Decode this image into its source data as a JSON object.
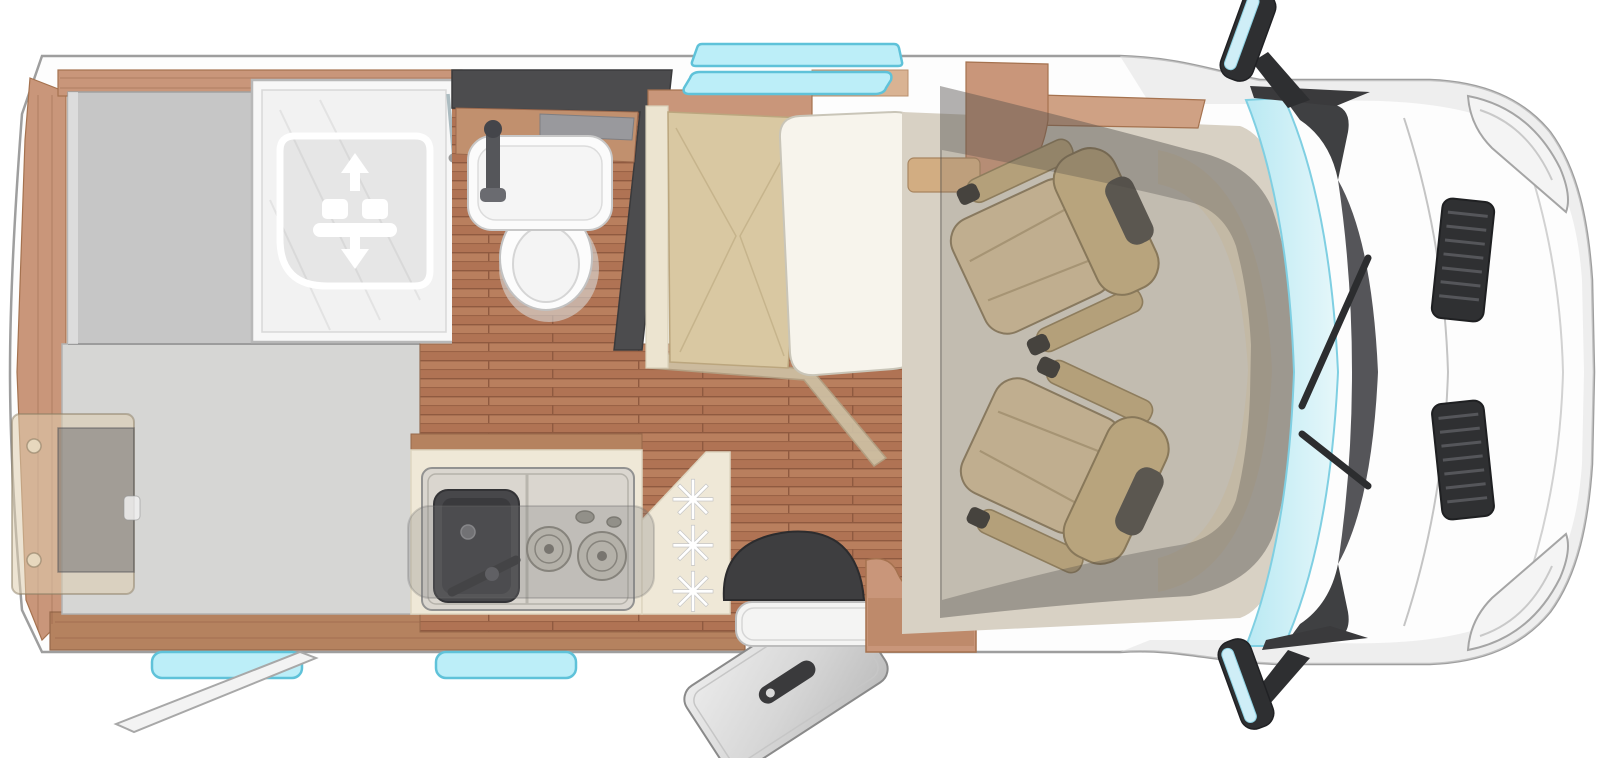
{
  "diagram": {
    "type": "motorhome-floorplan-top-view",
    "description": "Top-down 3D floor plan of a semi-integrated camper van: rear bed area with drop-down bed symbol, shower cabin, bathroom with washbasin and toilet, dark wardrobe wall, kitchen block with sink and two-burner hob, refrigerator position marked with snowflake symbols, half-dinette bench with table, two swivelled cab captain seats under translucent cab roof, open entry door with dark floor mat and wooden step, roof skylight and side windows, awning support arm, and the driving cab with windscreen, wipers, bonnet vents, headlights and two exterior mirrors.",
    "areas": [
      "rear-bed-platform-upper",
      "rear-bed-platform-lower",
      "shower-cabin",
      "drop-down-bed-lift-icon",
      "bathroom",
      "washbasin",
      "toilet",
      "wardrobe-dark-wall",
      "kitchen-counter",
      "kitchen-sink",
      "two-burner-hob",
      "fridge-panel-with-snowflakes",
      "dinette-bench",
      "dinette-table",
      "swivel-seat-front-left",
      "swivel-seat-front-right",
      "entry-door-open",
      "door-mat",
      "entry-step",
      "cab",
      "windshield",
      "exterior-mirrors",
      "awning-support-arm"
    ],
    "counts": {
      "snowflakes": 3,
      "hob_burners": 2,
      "swivel_seats": 2,
      "mirrors": 2,
      "bonnet_vents": 2,
      "headlights": 2,
      "bottom_wall_windows": 2,
      "top_wall_windows": 1,
      "skylights": 1
    },
    "states": {
      "entry_door": "open",
      "cab_seats": "swivelled-to-living-area"
    },
    "icons": {
      "snowflake": {
        "glyph": "✳",
        "meaning": "refrigerator / freezer position"
      },
      "bed_lift": {
        "meaning": "drop-down bed raises and lowers",
        "arrows": [
          "up",
          "down"
        ]
      }
    },
    "colors": {
      "body_white": "#fdfdfd",
      "outline_gray": "#9e9e9e",
      "wood_trim": "#c9967a",
      "wood_trim_dark": "#b5825f",
      "wood_floor": "#b97f5e",
      "counter_cream": "#efe8d7",
      "cushion_tan": "#d9c8a2",
      "seat_tan": "#d5c09a",
      "dark_wall": "#4c4c4e",
      "platform_gray": "#c6c6c6",
      "platform_gray_light": "#d6d6d4",
      "glass_cyan": "#bceef8",
      "glass_edge": "#5fc2d9",
      "mat_dark": "#3e3e40",
      "metal_silver": "#d9d6cf",
      "grille_dark": "#2f3032",
      "table_white": "#f7f4ec",
      "cab_floor_taupe": "#d8d1c4",
      "overlay_smoke": "rgba(110,107,102,0.20)"
    }
  }
}
